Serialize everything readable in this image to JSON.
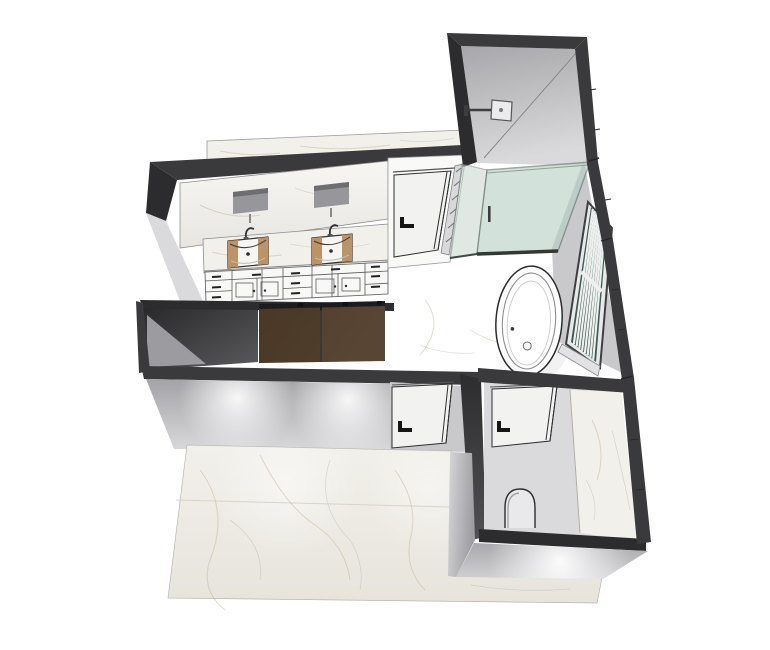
{
  "meta": {
    "title": "3D bathroom floor plan render",
    "view": "axonometric overhead cutaway",
    "software_chrome": "none (render only, white background)"
  },
  "colors": {
    "background": "#ffffff",
    "wall_dark": "#3a3a3c",
    "wall_darker": "#2c2c2e",
    "wall_gray": "#c9c9cc",
    "wall_gray_light": "#dadadc",
    "interior_gray": "#d4d4d7",
    "marble": "#f2f0ea",
    "marble_vein": "#c6b28c",
    "floor": "#fbfbfa",
    "wood_tan": "#bd9265",
    "wood_dark": "#4c3a29",
    "wood_dark2": "#564332",
    "glass": "#b7cfc3",
    "glass_edge": "#5f7268",
    "window_glass": "#3f5a52",
    "fixture_white": "#ffffff",
    "outline": "#2e2e30",
    "hardware_black": "#161617"
  },
  "scene": {
    "rooms": [
      {
        "id": "main-bathroom",
        "label": "main bathroom"
      },
      {
        "id": "shower-room",
        "label": "walk-in shower room"
      },
      {
        "id": "water-closet",
        "label": "toilet room"
      },
      {
        "id": "closet",
        "label": "wardrobe closet block"
      }
    ],
    "fixtures": [
      {
        "id": "vanity-mirror",
        "label": "vanity mirror with sink reflections"
      },
      {
        "id": "double-vanity",
        "label": "double vanity, marble counter, two vessel sinks with wood liners"
      },
      {
        "id": "vanity-cabinets",
        "label": "vanity drawer and door fronts"
      },
      {
        "id": "rain-shower-head",
        "label": "wall mounted square shower head"
      },
      {
        "id": "glass-shower-screen",
        "label": "green tinted glass shower screen"
      },
      {
        "id": "freestanding-bathtub",
        "label": "freestanding oval bathtub"
      },
      {
        "id": "slatted-window",
        "label": "slatted window on right wall"
      },
      {
        "id": "toilet",
        "label": "toilet"
      },
      {
        "id": "door-shower",
        "label": "upper hinged door with black lever handle"
      },
      {
        "id": "door-entry",
        "label": "entry door with black lever handle"
      },
      {
        "id": "door-wc",
        "label": "toilet room door with black lever handle"
      },
      {
        "id": "wardrobe-panels",
        "label": "dark wood wardrobe panels"
      },
      {
        "id": "downlights",
        "label": "wall-wash downlight glows"
      }
    ]
  }
}
